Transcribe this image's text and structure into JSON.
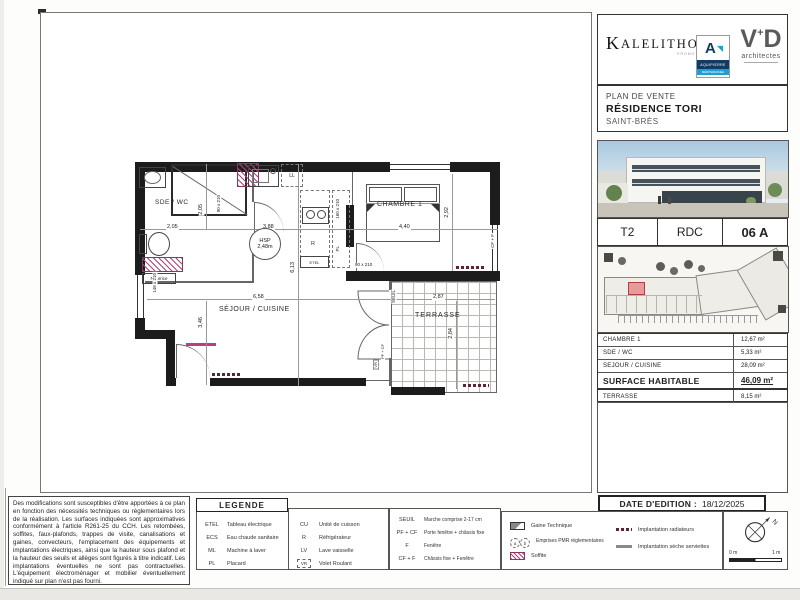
{
  "branding": {
    "kalelithos": "KALELITHOS",
    "kalelithos_sub": "PROMOTION",
    "aquipierre_letter": "A",
    "aquipierre": "AQUIPIERRE",
    "aquipierre_sub": "MÉDITERRANÉE",
    "vd_v": "V",
    "vd_plus": "+",
    "vd_d": "D",
    "vd_sub": "architectes"
  },
  "title_block": {
    "line1": "PLAN DE VENTE",
    "line2": "RÉSIDENCE TORI",
    "line3": "SAINT-BRÈS"
  },
  "unit": {
    "type": "T2",
    "floor": "RDC",
    "number": "06 A"
  },
  "areas": {
    "rows": [
      {
        "label": "CHAMBRE 1",
        "value": "12,67  m²"
      },
      {
        "label": "SDE / WC",
        "value": "5,33  m²"
      },
      {
        "label": "SEJOUR / CUISINE",
        "value": "28,09  m²"
      }
    ],
    "total": {
      "label": "SURFACE HABITABLE",
      "value": "46,09 m²"
    },
    "terrace": {
      "label": "TERRASSE",
      "value": "8,15  m²"
    }
  },
  "edition": {
    "label": "DATE D'EDITION :",
    "date": "18/12/2025"
  },
  "disclaimer": "Des modifications sont susceptibles d'être apportées à ce plan en fonction des nécessités techniques ou réglementaires lors de la réalisation. Les surfaces indiquées sont approximatives conformément à l'article R261-25 du CCH. Les retombées, soffites, faux-plafonds, trappes de visite, canalisations et gaines, convecteurs, l'emplacement des équipements et implantations électriques, ainsi que la hauteur sous plafond et la hauteur des seuils et allèges sont figurés à titre indicatif. Les implantations éventuelles ne sont pas contractuelles. L'équipement électroménager et mobilier éventuellement indiqué sur plan n'est pas fourni.",
  "legend": {
    "title": "LEGENDE",
    "col1": [
      {
        "abbr": "ETEL",
        "label": "Tableau électrique"
      },
      {
        "abbr": "ECS",
        "label": "Eau chaude sanitaire"
      },
      {
        "abbr": "ML",
        "label": "Machine à laver"
      },
      {
        "abbr": "PL",
        "label": "Placard"
      }
    ],
    "col2": [
      {
        "abbr": "CU",
        "label": "Unité de cuisson"
      },
      {
        "abbr": "R",
        "label": "Réfrigérateur"
      },
      {
        "abbr": "LV",
        "label": "Lave vaisselle"
      },
      {
        "abbr": "VR",
        "label": "Volet Roulant"
      }
    ],
    "col3": [
      {
        "abbr": "SEUIL",
        "label": "Marche comprise 2-17 cm"
      },
      {
        "abbr": "PF + CF",
        "label": "Porte fenêtre + châssis fixe"
      },
      {
        "abbr": "F",
        "label": "Fenêtre"
      },
      {
        "abbr": "CF + F",
        "label": "Châssis fixe + Fenêtre"
      }
    ],
    "col4": [
      {
        "label": "Gaine Technique"
      },
      {
        "label": "Emprises PMR réglementaires"
      },
      {
        "label": "Soffite"
      }
    ],
    "col5": [
      {
        "label": "Implantation radiateurs"
      },
      {
        "label": "Implantation sèche serviettes"
      }
    ],
    "pmr_a": "a",
    "pmr_b": "b",
    "north": "N",
    "scale_left": "0 m",
    "scale_right": "1 m"
  },
  "plan": {
    "labels": {
      "sdewc": "SDE / WC",
      "sejour": "SÉJOUR / CUISINE",
      "chambre": "CHAMBRE 1",
      "terrasse": "TERRASSE",
      "hsp1": "HSP",
      "hsp2": "2,48m",
      "nourrice": "Nourrice",
      "ll": "LL",
      "r": "R",
      "etel": "ETEL",
      "pl": "PL",
      "seuil": "SEUIL",
      "pfcf": "PF + CF",
      "cff": "CF + F",
      "vr": "VR"
    },
    "dims": {
      "a205h": "2,05",
      "a205v": "2,05",
      "a388": "3,88",
      "a440": "4,40",
      "a292": "2,92",
      "a613": "6,13",
      "a658": "6,58",
      "a346": "3,46",
      "a287": "2,87",
      "a284": "2,84",
      "door90a": "90 x 210",
      "door90b": "90 x 210",
      "win148": "148 x 210",
      "pl160": "160 x 210"
    }
  },
  "colors": {
    "wall": "#1c1c1c",
    "accent_pink": "#b4407e",
    "aqui_navy": "#123a63",
    "aqui_cyan": "#1b9fd4",
    "highlight_unit_red": "#b04040"
  }
}
